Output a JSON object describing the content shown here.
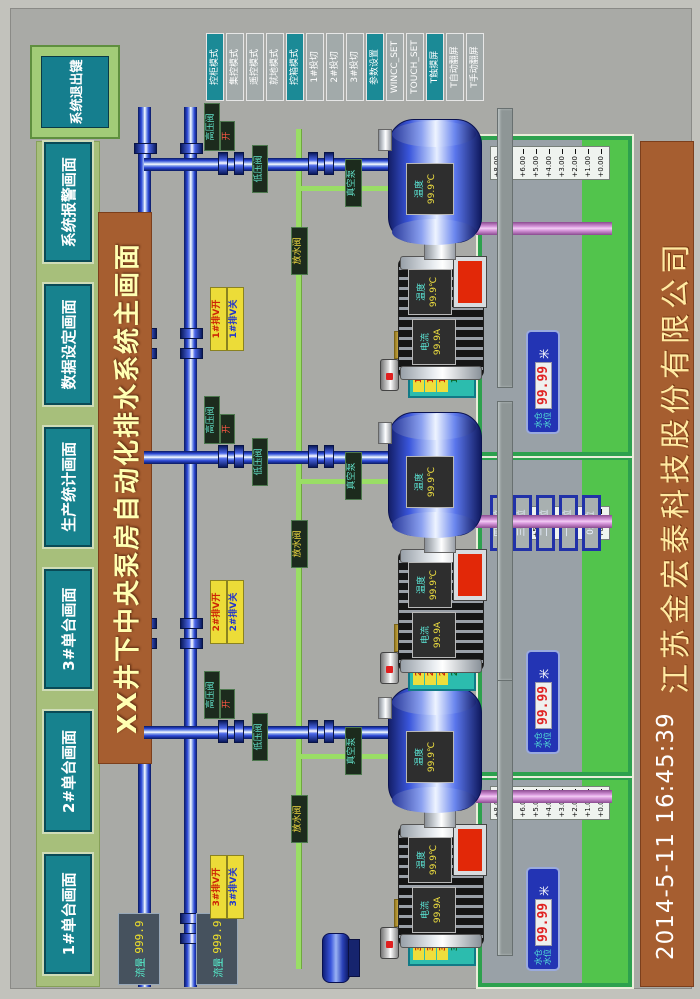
{
  "topbar": {
    "buttons": [
      "1#单台画面",
      "2#单台画面",
      "3#单台画面",
      "生产统计画面",
      "数据设定画面",
      "系统报警画面"
    ],
    "exit_label": "系统退出键"
  },
  "titlebar": {
    "title": "XX井下中央泵房自动化排水系统主画面"
  },
  "mode_buttons": [
    {
      "label": "控柜模式",
      "accent": true
    },
    {
      "label": "集控模式",
      "accent": false
    },
    {
      "label": "遥控模式",
      "accent": false
    },
    {
      "label": "就地模式",
      "accent": false
    },
    {
      "label": "控箱模式",
      "accent": true
    },
    {
      "label": "1#投切",
      "accent": false
    },
    {
      "label": "2#投切",
      "accent": false
    },
    {
      "label": "3#投切",
      "accent": false
    },
    {
      "label": "参数设置",
      "accent": true
    },
    {
      "label": "WINCC_SET",
      "accent": false
    },
    {
      "label": "TOUCH_SET",
      "accent": false
    },
    {
      "label": "T触摸屏",
      "accent": true
    },
    {
      "label": "T自动翻屏",
      "accent": false
    },
    {
      "label": "T手动翻屏",
      "accent": false
    }
  ],
  "flow_displays": [
    {
      "label": "流量",
      "value": "999.9"
    },
    {
      "label": "流量",
      "value": "999.9"
    }
  ],
  "pumps": [
    {
      "id": "3#",
      "valve_open": "3#排V开",
      "valve_close": "3#排V关",
      "hv_label": "高压阀",
      "hv_state": "开",
      "lv_label": "低压阀",
      "drain_label": "放水阀",
      "vacuum_label": "真空泵",
      "temp_label": "温度",
      "temp_value": "99.9℃",
      "current_label": "电流",
      "current_value": "99.9A",
      "motor_temp_label": "温度",
      "motor_temp_value": "99.9℃",
      "box_open": "3#管阀开",
      "box_close": "3#管阀关",
      "box_stop": "3#管阀停",
      "box_station": "3#液压站"
    },
    {
      "id": "2#",
      "valve_open": "2#排V开",
      "valve_close": "2#排V关",
      "hv_label": "高压阀",
      "hv_state": "开",
      "lv_label": "低压阀",
      "drain_label": "放水阀",
      "vacuum_label": "真空泵",
      "temp_label": "温度",
      "temp_value": "99.9℃",
      "current_label": "电流",
      "current_value": "99.9A",
      "motor_temp_label": "温度",
      "motor_temp_value": "99.9℃",
      "box_open": "2#管阀开",
      "box_close": "2#管阀关",
      "box_stop": "2#管阀停",
      "box_station": "2#液压站"
    },
    {
      "id": "1#",
      "valve_open": "1#排V开",
      "valve_close": "1#排V关",
      "hv_label": "高压阀",
      "hv_state": "开",
      "lv_label": "低压阀",
      "drain_label": "放水阀",
      "vacuum_label": "真空泵",
      "temp_label": "温度",
      "temp_value": "99.9℃",
      "current_label": "电流",
      "current_value": "99.9A",
      "motor_temp_label": "温度",
      "motor_temp_value": "99.9℃",
      "box_open": "1#管阀开",
      "box_close": "1#管阀关",
      "box_stop": "1#管阀停",
      "box_station": "1#液压站"
    }
  ],
  "tanks": [
    {
      "label1": "水仓",
      "label2": "水位",
      "value": "99.99",
      "unit": "米"
    },
    {
      "label1": "水仓",
      "label2": "水位",
      "value": "99.99",
      "unit": "米"
    },
    {
      "label1": "水仓",
      "label2": "水位",
      "value": "99.99",
      "unit": "米"
    }
  ],
  "scale_labels": [
    "+8.00",
    "+7.00",
    "+6.00",
    "+5.00",
    "+4.00",
    "+3.00",
    "+2.00",
    "+1.00",
    "+0.00"
  ],
  "level_lamps": [
    "四米位",
    "三米位",
    "二米位",
    "一米位",
    "0米位"
  ],
  "footer": {
    "datetime": "2014-5-11  16:45:39",
    "company": "江苏金宏泰科技股份有限公司"
  },
  "colors": {
    "accent_teal": "#17828e",
    "bar_olive": "#a7bf7b",
    "panel_brown": "#a65e30",
    "pipe_blue": "#2a46d4",
    "pipe_green": "#9ade66",
    "pipe_purple": "#d898dc",
    "water_green": "#52c44c",
    "alarm_red": "#e22808",
    "label_yellow": "#ecdc38"
  }
}
